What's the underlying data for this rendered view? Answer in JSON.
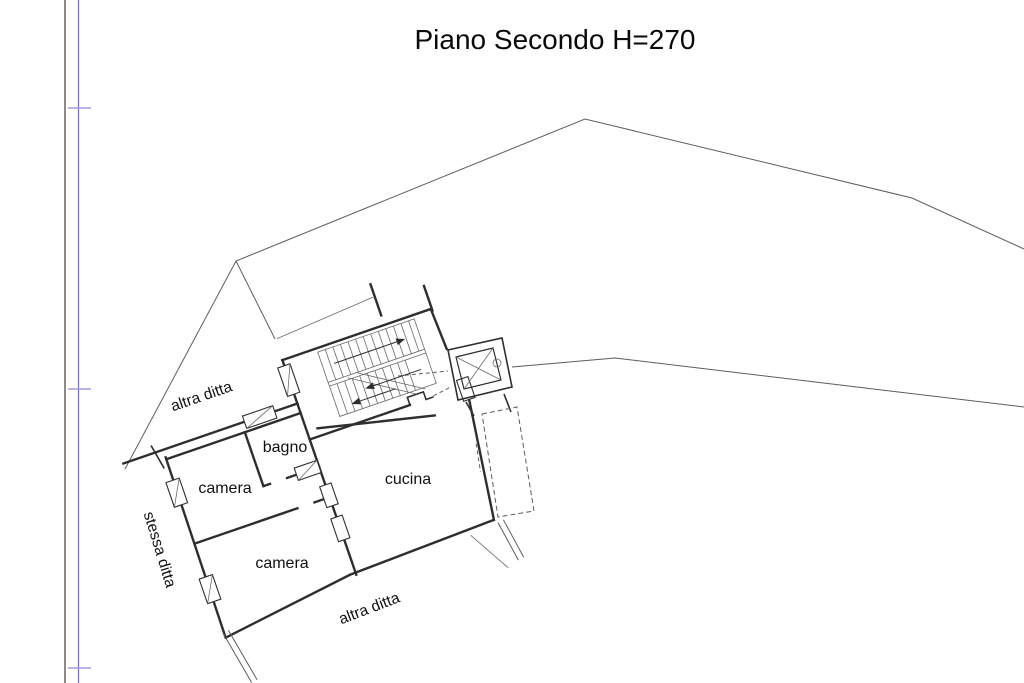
{
  "title": "Piano Secondo H=270",
  "plan": {
    "rooms": [
      {
        "label": "bagno"
      },
      {
        "label": "camera"
      },
      {
        "label": "cucina"
      },
      {
        "label": "camera"
      }
    ],
    "neighbors": {
      "top": "altra ditta",
      "left": "stessa ditta",
      "bottom": "altra ditta"
    },
    "features": [
      {
        "name": "staircase"
      },
      {
        "name": "elevator"
      },
      {
        "name": "balcony"
      }
    ]
  },
  "frame": {
    "margin_line_color": "#3f3f37",
    "ruler_line_color": "#6f6fc9",
    "tick_color": "#a29bda"
  }
}
